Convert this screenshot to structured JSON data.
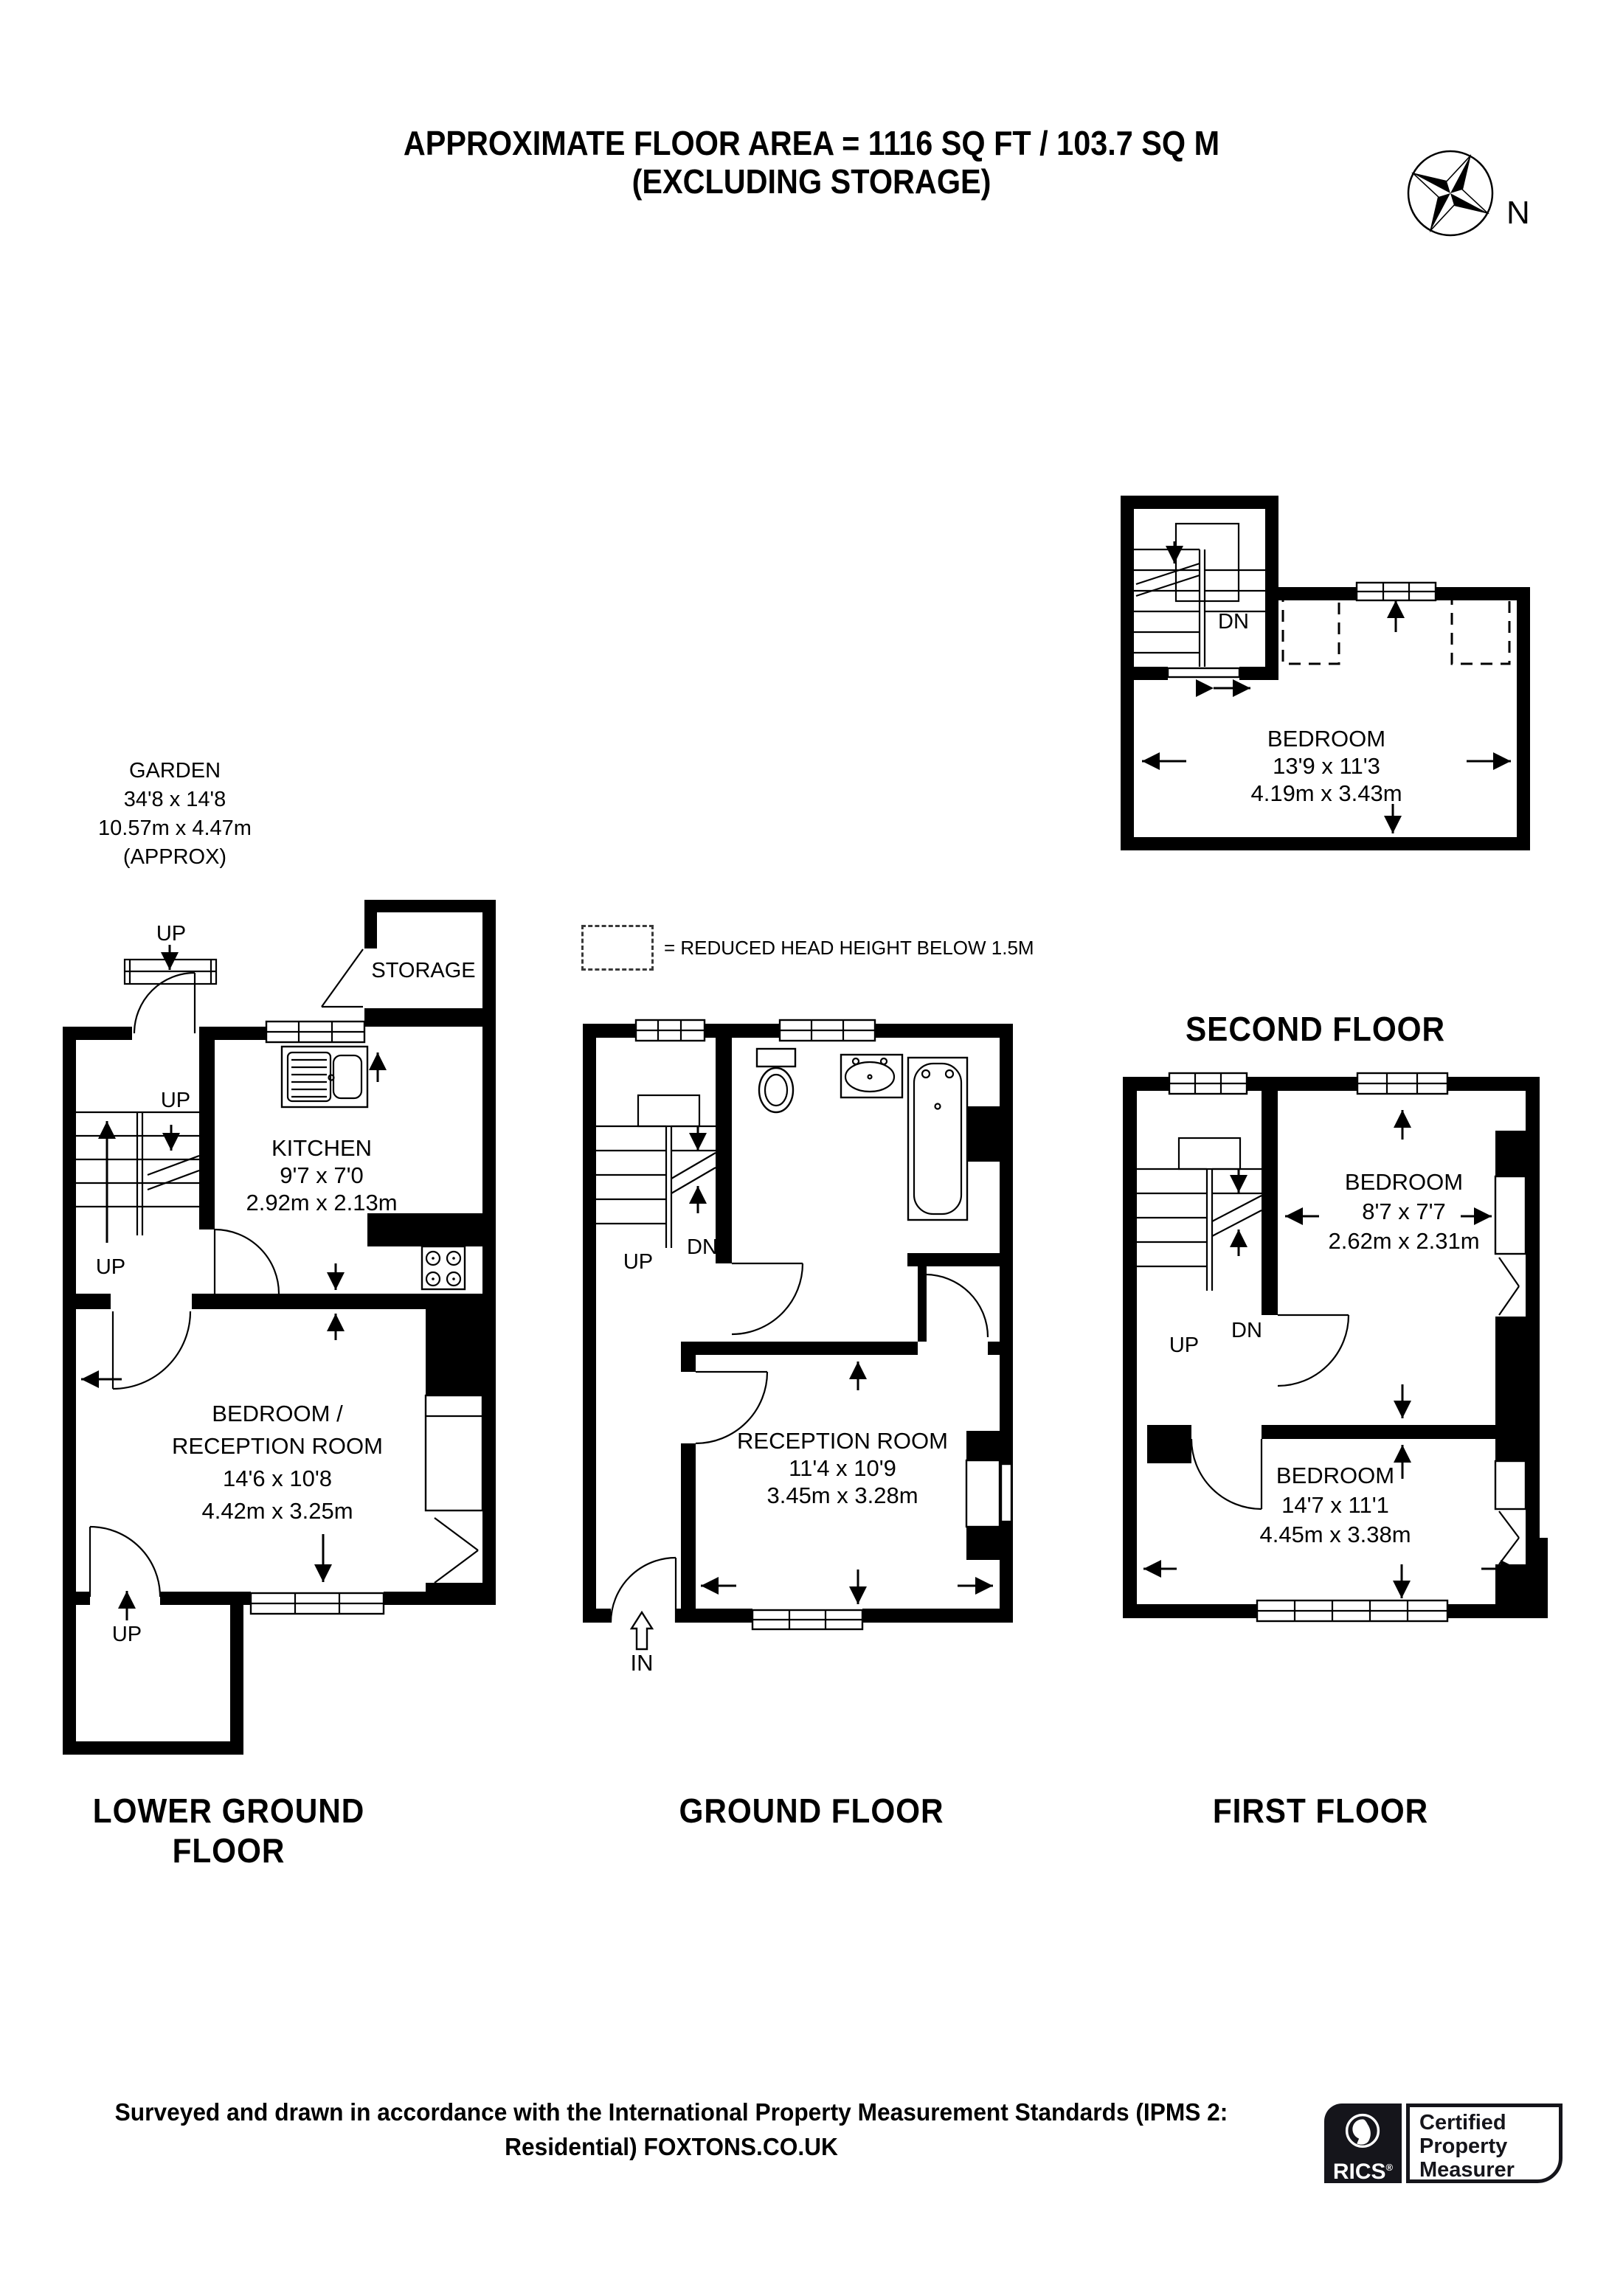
{
  "title": {
    "line1": "APPROXIMATE FLOOR AREA = 1116 SQ FT / 103.7 SQ M",
    "line2": "(EXCLUDING STORAGE)"
  },
  "compass": {
    "label": "N"
  },
  "legend": {
    "text": "= REDUCED HEAD HEIGHT BELOW 1.5M"
  },
  "garden": {
    "name": "GARDEN",
    "dim_ft": "34'8 x 14'8",
    "dim_m": "10.57m x 4.47m",
    "note": "(APPROX)"
  },
  "floors": {
    "second": {
      "label": "SECOND FLOOR",
      "dn": "DN",
      "bedroom": {
        "name": "BEDROOM",
        "dim_ft": "13'9 x 11'3",
        "dim_m": "4.19m x 3.43m"
      }
    },
    "first": {
      "label": "FIRST FLOOR",
      "up": "UP",
      "dn": "DN",
      "bedroom_small": {
        "name": "BEDROOM",
        "dim_ft": "8'7 x 7'7",
        "dim_m": "2.62m x 2.31m"
      },
      "bedroom_large": {
        "name": "BEDROOM",
        "dim_ft": "14'7 x 11'1",
        "dim_m": "4.45m x 3.38m"
      }
    },
    "ground": {
      "label": "GROUND FLOOR",
      "up": "UP",
      "dn": "DN",
      "entrance": "IN",
      "reception": {
        "name": "RECEPTION ROOM",
        "dim_ft": "11'4 x 10'9",
        "dim_m": "3.45m x 3.28m"
      }
    },
    "lower_ground": {
      "label": "LOWER GROUND FLOOR",
      "storage": "STORAGE",
      "up_entrance": "UP",
      "up_stairs_top": "UP",
      "up_stairs_side": "UP",
      "up_vault": "UP",
      "kitchen": {
        "name": "KITCHEN",
        "dim_ft": "9'7 x 7'0",
        "dim_m": "2.92m x 2.13m"
      },
      "bedroom_reception": {
        "name_line1": "BEDROOM /",
        "name_line2": "RECEPTION ROOM",
        "dim_ft": "14'6 x 10'8",
        "dim_m": "4.42m x 3.25m"
      }
    }
  },
  "footer": {
    "line1": "Surveyed and drawn in accordance with the International Property Measurement Standards (IPMS 2:",
    "line2": "Residential) FOXTONS.CO.UK"
  },
  "rics": {
    "brand": "RICS",
    "reg": "®",
    "line1": "Certified",
    "line2": "Property",
    "line3": "Measurer"
  }
}
